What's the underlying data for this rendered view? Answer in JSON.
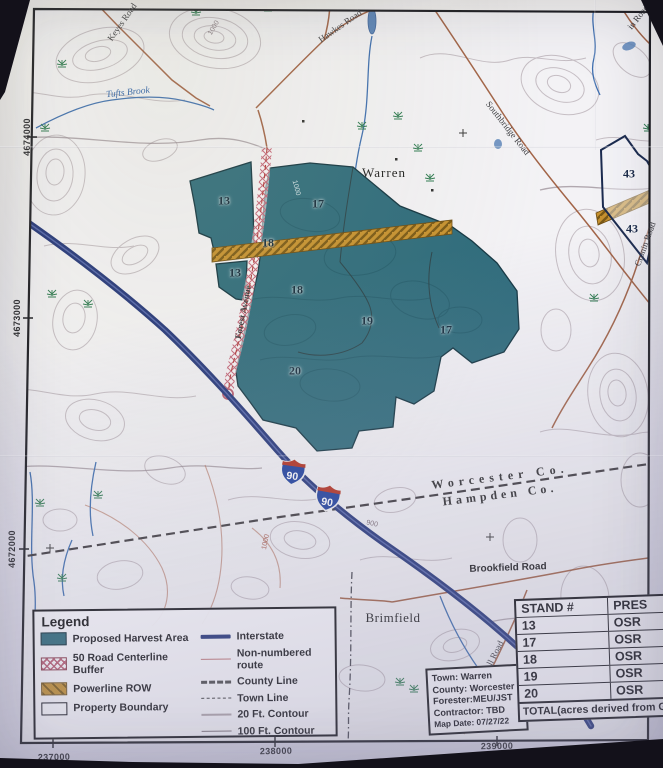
{
  "map": {
    "towns": {
      "warren": "Warren",
      "brimfield": "Brimfield"
    },
    "county_line": {
      "upper": "Worcester Co.",
      "lower": "Hampden Co."
    },
    "roads": {
      "keyes": "Keyes Road",
      "hawkes": "Hawkes Road",
      "southbridge": "Southbridge Road",
      "forest": "Forest Avenue",
      "cronin": "Cronin Road",
      "top_right_partial": "in Road",
      "mill_partial": "ll Road",
      "brookfield": "Brookfield Road"
    },
    "water": {
      "tufts_brook": "Tufts Brook"
    },
    "contour_labels": [
      "1000",
      "1000",
      "900",
      "1000"
    ],
    "stand_labels": [
      "13",
      "17",
      "18",
      "13",
      "18",
      "19",
      "17",
      "20"
    ],
    "property_labels": [
      "43",
      "43"
    ],
    "interstate_shield": "90",
    "grid": {
      "left": [
        "4674000",
        "4673000",
        "4672000"
      ],
      "bottom": [
        "237000",
        "238000",
        "239000"
      ]
    }
  },
  "legend": {
    "title": "Legend",
    "area_items": [
      {
        "label": "Proposed Harvest Area"
      },
      {
        "label": "50 Road Centerline Buffer"
      },
      {
        "label": "Powerline ROW"
      },
      {
        "label": "Property Boundary"
      }
    ],
    "line_items": [
      {
        "label": "Interstate"
      },
      {
        "label": "Non-numbered route"
      },
      {
        "label": "County Line"
      },
      {
        "label": "Town Line"
      },
      {
        "label": "20 Ft. Contour"
      },
      {
        "label": "100 Ft. Contour"
      }
    ]
  },
  "info_box": {
    "town": "Town: Warren",
    "county": "County: Worcester",
    "forester": "Forester:MEU/JST",
    "contractor": "Contractor: TBD",
    "map_date": "Map Date: 07/27/22"
  },
  "stand_table": {
    "headers": [
      "STAND #",
      "PRES"
    ],
    "rows": [
      {
        "stand": "13",
        "pres": "OSR"
      },
      {
        "stand": "17",
        "pres": "OSR"
      },
      {
        "stand": "18",
        "pres": "OSR"
      },
      {
        "stand": "19",
        "pres": "OSR"
      },
      {
        "stand": "20",
        "pres": "OSR"
      }
    ],
    "footer": "TOTAL(acres derived from GIS"
  },
  "colors": {
    "harvest": "#2e6b7b",
    "powerline_gold": "#c79230",
    "buffer_pink": "#c4677a",
    "interstate_navy": "#24367a",
    "shield_red": "#b5301f",
    "shield_blue": "#1d3f9e"
  }
}
